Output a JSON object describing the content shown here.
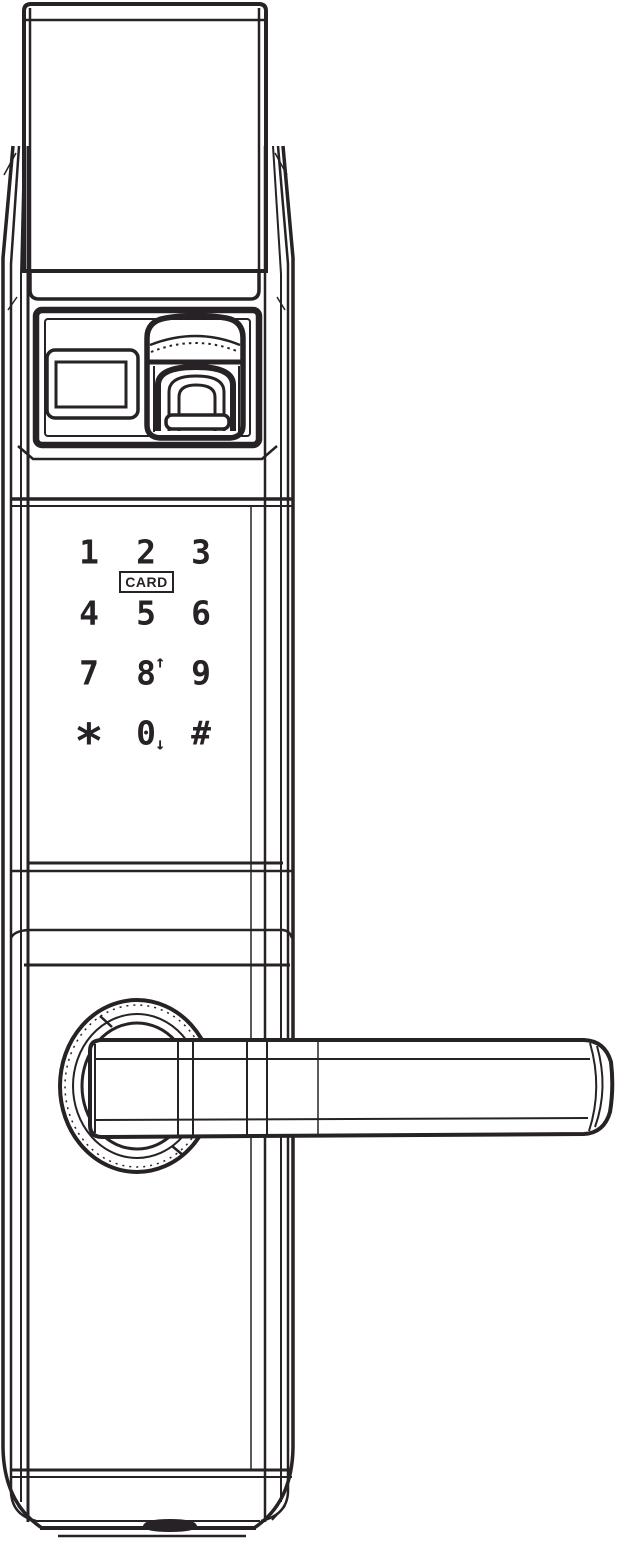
{
  "colors": {
    "line": "#272226",
    "background": "#ffffff"
  },
  "components": {
    "top_cover": "top-cover-panel",
    "display": "display-screen",
    "fingerprint": "fingerprint-reader-icon",
    "handle": "lever-handle",
    "slot": "usb-slot"
  },
  "keypad": {
    "card_label": "CARD",
    "keys": [
      {
        "label": "1"
      },
      {
        "label": "2"
      },
      {
        "label": "3"
      },
      {
        "label": "4"
      },
      {
        "label": "5"
      },
      {
        "label": "6"
      },
      {
        "label": "7"
      },
      {
        "label": "8",
        "arrow": "↑"
      },
      {
        "label": "9"
      },
      {
        "label": "*"
      },
      {
        "label": "0",
        "arrow": "↓"
      },
      {
        "label": "#"
      }
    ]
  }
}
